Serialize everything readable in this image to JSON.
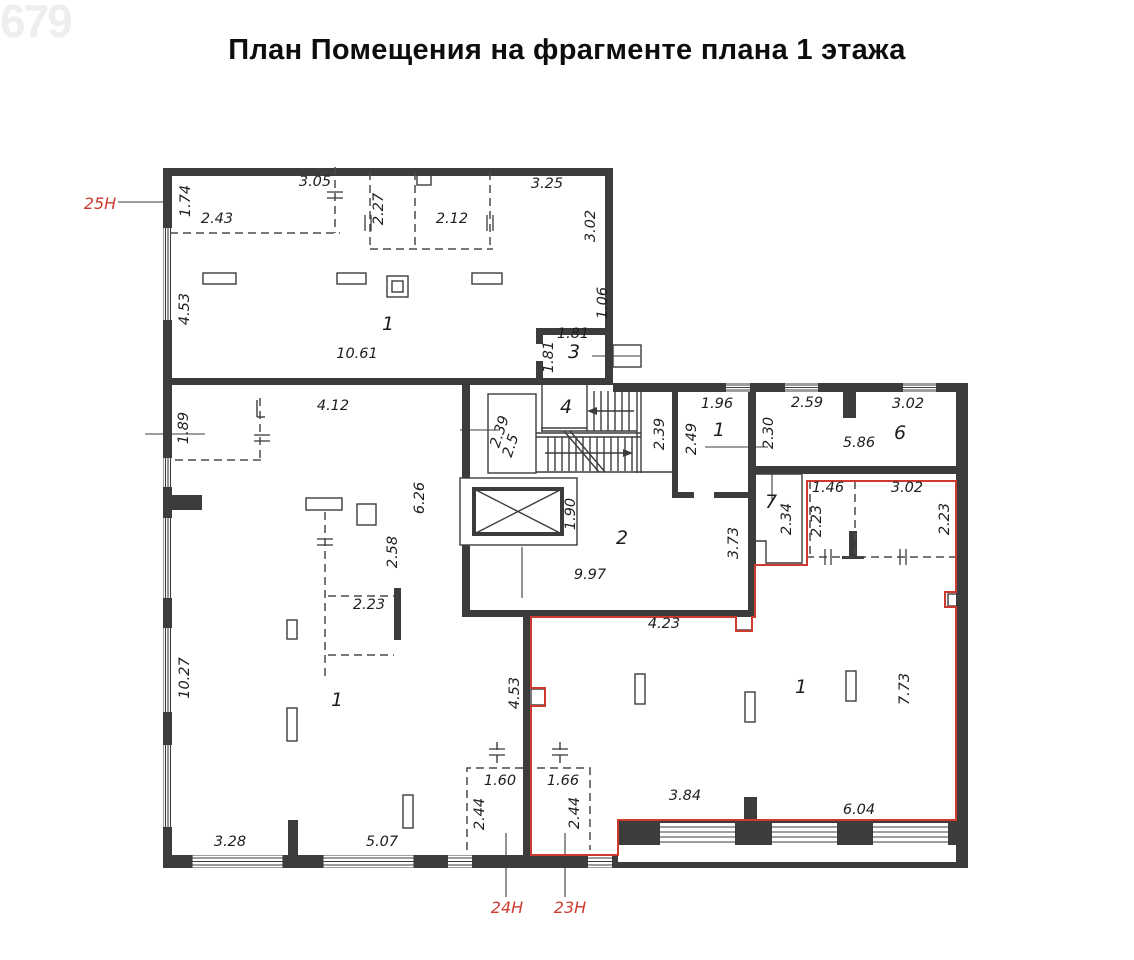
{
  "page": {
    "title": "План Помещения на фрагменте плана 1 этажа",
    "watermark": "679"
  },
  "colors": {
    "wall": "#3c3c3c",
    "red": "#cf3a2e",
    "background": "#ffffff"
  },
  "plan": {
    "premises": [
      {
        "t": "25Н",
        "x": 100,
        "y": 209
      },
      {
        "t": "24Н",
        "x": 507,
        "y": 913
      },
      {
        "t": "23Н",
        "x": 570,
        "y": 913
      }
    ],
    "rooms": [
      {
        "t": "1",
        "x": 388,
        "y": 330
      },
      {
        "t": "3",
        "x": 574,
        "y": 358
      },
      {
        "t": "4",
        "x": 566,
        "y": 413
      },
      {
        "t": "1",
        "x": 719,
        "y": 436
      },
      {
        "t": "2",
        "x": 622,
        "y": 544
      },
      {
        "t": "6",
        "x": 900,
        "y": 439
      },
      {
        "t": "7",
        "x": 771,
        "y": 508
      },
      {
        "t": "1",
        "x": 337,
        "y": 706
      },
      {
        "t": "1",
        "x": 801,
        "y": 693
      }
    ],
    "dimensions": [
      {
        "t": "1.74",
        "x": 190,
        "y": 201,
        "r": -90
      },
      {
        "t": "2.43",
        "x": 217,
        "y": 223
      },
      {
        "t": "3.05",
        "x": 315,
        "y": 186
      },
      {
        "t": "2.27",
        "x": 383,
        "y": 209,
        "r": -90
      },
      {
        "t": "2.12",
        "x": 452,
        "y": 223
      },
      {
        "t": "3.25",
        "x": 547,
        "y": 188
      },
      {
        "t": "3.02",
        "x": 595,
        "y": 226,
        "r": -90
      },
      {
        "t": "4.53",
        "x": 189,
        "y": 309,
        "r": -90
      },
      {
        "t": "1.06",
        "x": 607,
        "y": 303,
        "r": -90
      },
      {
        "t": "1.81",
        "x": 573,
        "y": 338
      },
      {
        "t": "1.81",
        "x": 553,
        "y": 357,
        "r": -90
      },
      {
        "t": "10.61",
        "x": 357,
        "y": 358
      },
      {
        "t": "4.12",
        "x": 333,
        "y": 410
      },
      {
        "t": "1.89",
        "x": 188,
        "y": 428,
        "r": -90
      },
      {
        "t": "2.39",
        "x": 504,
        "y": 433,
        "r": -72
      },
      {
        "t": "2.5",
        "x": 515,
        "y": 447,
        "r": -72
      },
      {
        "t": "2.39",
        "x": 664,
        "y": 434,
        "r": -90
      },
      {
        "t": "2.49",
        "x": 696,
        "y": 439,
        "r": -90
      },
      {
        "t": "1.96",
        "x": 717,
        "y": 408
      },
      {
        "t": "2.30",
        "x": 773,
        "y": 433,
        "r": -90
      },
      {
        "t": "2.59",
        "x": 807,
        "y": 407
      },
      {
        "t": "3.02",
        "x": 908,
        "y": 408
      },
      {
        "t": "5.86",
        "x": 859,
        "y": 447
      },
      {
        "t": "6.26",
        "x": 424,
        "y": 498,
        "r": -90
      },
      {
        "t": "2.58",
        "x": 397,
        "y": 552,
        "r": -90
      },
      {
        "t": "1.90",
        "x": 575,
        "y": 514,
        "r": -90
      },
      {
        "t": "9.97",
        "x": 590,
        "y": 579
      },
      {
        "t": "2.23",
        "x": 369,
        "y": 609
      },
      {
        "t": "2.34",
        "x": 791,
        "y": 519,
        "r": -90
      },
      {
        "t": "3.73",
        "x": 738,
        "y": 543,
        "r": -90
      },
      {
        "t": "1.46",
        "x": 828,
        "y": 492
      },
      {
        "t": "3.02",
        "x": 907,
        "y": 492
      },
      {
        "t": "2.23",
        "x": 821,
        "y": 521,
        "r": -90
      },
      {
        "t": "2.23",
        "x": 949,
        "y": 519,
        "r": -90
      },
      {
        "t": "4.23",
        "x": 664,
        "y": 628
      },
      {
        "t": "10.27",
        "x": 189,
        "y": 678,
        "r": -90
      },
      {
        "t": "4.53",
        "x": 519,
        "y": 693,
        "r": -90
      },
      {
        "t": "7.73",
        "x": 909,
        "y": 689,
        "r": -90
      },
      {
        "t": "1.60",
        "x": 500,
        "y": 785
      },
      {
        "t": "1.66",
        "x": 563,
        "y": 785
      },
      {
        "t": "2.44",
        "x": 484,
        "y": 814,
        "r": -90
      },
      {
        "t": "2.44",
        "x": 579,
        "y": 813,
        "r": -90
      },
      {
        "t": "3.84",
        "x": 685,
        "y": 800
      },
      {
        "t": "6.04",
        "x": 859,
        "y": 814
      },
      {
        "t": "3.28",
        "x": 230,
        "y": 846
      },
      {
        "t": "5.07",
        "x": 382,
        "y": 846
      }
    ]
  }
}
